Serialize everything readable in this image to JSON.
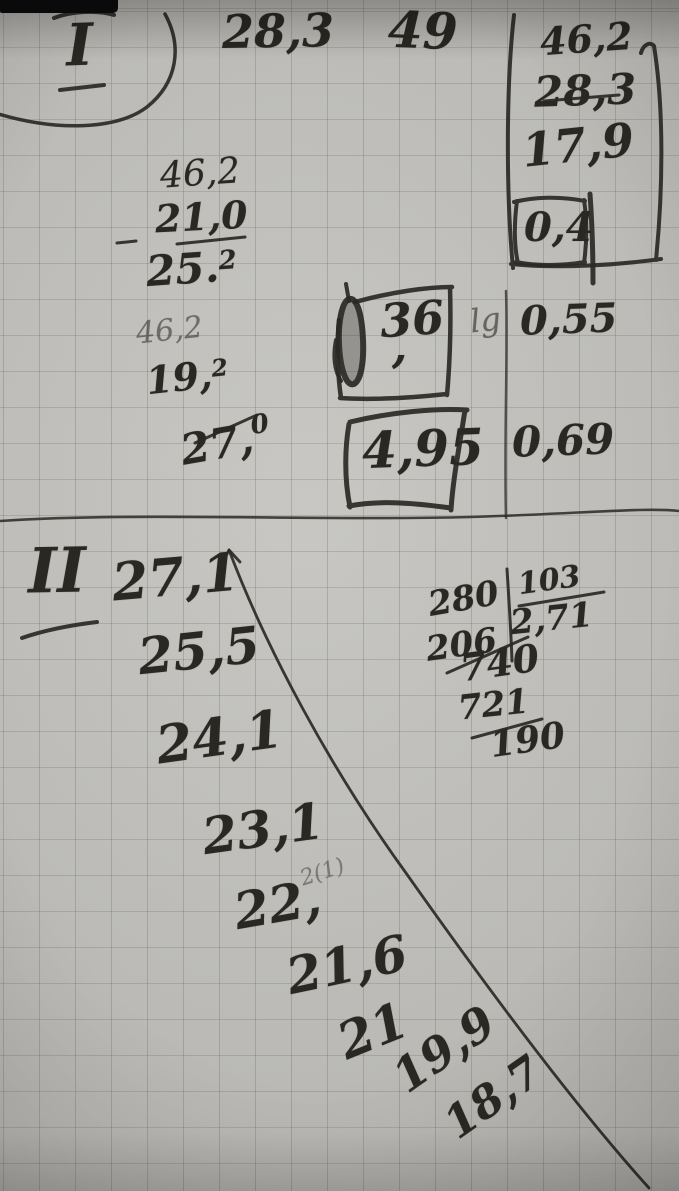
{
  "photo": {
    "description": "handwritten calculations on squared notebook paper"
  },
  "section1": {
    "label": "I",
    "top_value": "28,3",
    "scribble": "49",
    "right_calc": {
      "row1": "46,2",
      "row2": "28,3",
      "row3": "17,9",
      "result": "0,4"
    },
    "sub1": {
      "minuend": "46,2",
      "subtrahend": "21,0",
      "result": "25.",
      "result_sup": "2"
    },
    "sub2": {
      "minuend": "46,2",
      "subtrahend": "19,",
      "subtrahend_sup": "2",
      "result": "27,",
      "result_sup": "0"
    },
    "box36": {
      "value": "36",
      "comma": ","
    },
    "lg_label": "lg",
    "value_055": "0,55",
    "value_069": "0,69",
    "box495": "4,95"
  },
  "section2": {
    "label": "II",
    "series": [
      "27,1",
      "25,5",
      "24,1",
      "23,1",
      "22,",
      "21,6",
      "21",
      "19,9",
      "18,7"
    ],
    "faint_note": "2(1)",
    "division": {
      "dividend": "280",
      "step_sub": "206",
      "divisor": "103",
      "quotient": "2,71",
      "bring_down": "740",
      "step_sub2": "721",
      "remainder": "190"
    }
  }
}
